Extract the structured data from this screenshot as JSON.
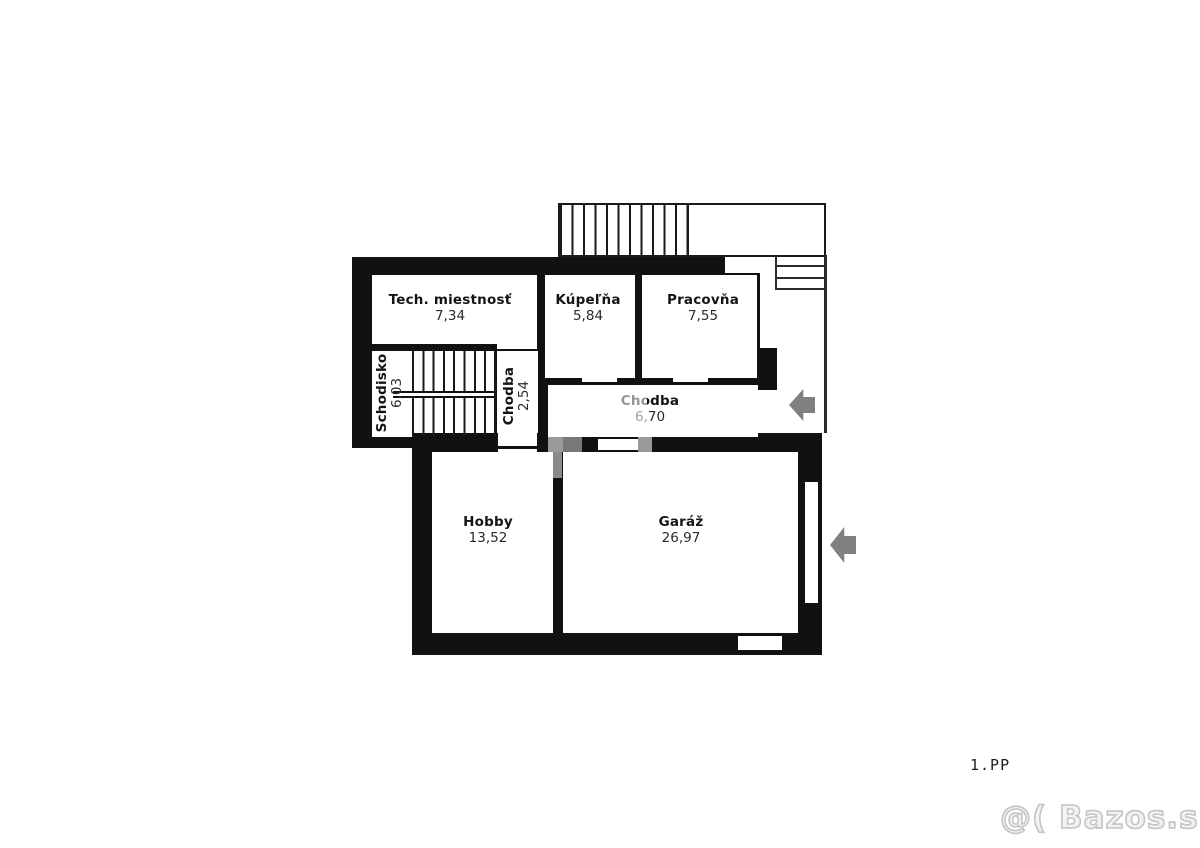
{
  "floorplan": {
    "floor_label": "1.PP",
    "rooms": [
      {
        "name": "Tech. miestnosť",
        "area": "7,34"
      },
      {
        "name": "Kúpeľňa",
        "area": "5,84"
      },
      {
        "name": "Pracovňa",
        "area": "7,55"
      },
      {
        "name": "Schodisko",
        "area": "6,03"
      },
      {
        "name": "Chodba",
        "area": "2,54"
      },
      {
        "name": "Chodba",
        "area": "6,70"
      },
      {
        "name": "Hobby",
        "area": "13,52"
      },
      {
        "name": "Garáž",
        "area": "26,97"
      }
    ],
    "colors": {
      "wall": "#111111",
      "arrow": "#808080",
      "watermark": "#c4c4c4"
    }
  },
  "watermark": {
    "site": "@( Bazos.sk"
  }
}
